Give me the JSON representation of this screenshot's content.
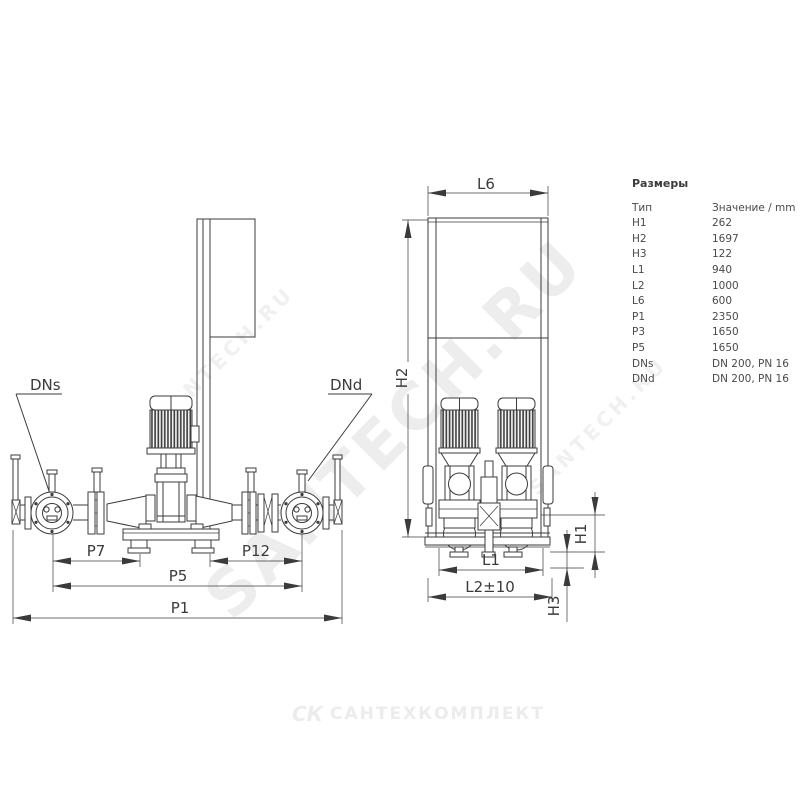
{
  "colors": {
    "ink": "#3b3b3b",
    "watermark_gray": "#c9c9c9",
    "logo_gray": "#ececec"
  },
  "watermarks": {
    "primary": "SANTECH.RU",
    "secondary": "SANTECH.RU",
    "tertiary": "SANTECH.RU"
  },
  "footer_logo": {
    "icon": "СК",
    "text": "САНТЕХКОМПЛЕКТ"
  },
  "dimensions_table": {
    "title": "Размеры",
    "header": {
      "type": "Тип",
      "value": "Значение / mm"
    },
    "rows": [
      {
        "type": "H1",
        "value": "262"
      },
      {
        "type": "H2",
        "value": "1697"
      },
      {
        "type": "H3",
        "value": "122"
      },
      {
        "type": "L1",
        "value": "940"
      },
      {
        "type": "L2",
        "value": "1000"
      },
      {
        "type": "L6",
        "value": "600"
      },
      {
        "type": "P1",
        "value": "2350"
      },
      {
        "type": "P3",
        "value": "1650"
      },
      {
        "type": "P5",
        "value": "1650"
      },
      {
        "type": "DNs",
        "value": "DN 200, PN 16"
      },
      {
        "type": "DNd",
        "value": "DN 200, PN 16"
      }
    ]
  },
  "front_view": {
    "labels": {
      "dns": "DNs",
      "dnd": "DNd",
      "p7": "P7",
      "p12": "P12",
      "p5": "P5",
      "p1": "P1"
    }
  },
  "side_view": {
    "labels": {
      "l6": "L6",
      "h2": "H2",
      "h1": "H1",
      "l1": "L1",
      "l2": "L2±10",
      "h3": "H3"
    }
  }
}
